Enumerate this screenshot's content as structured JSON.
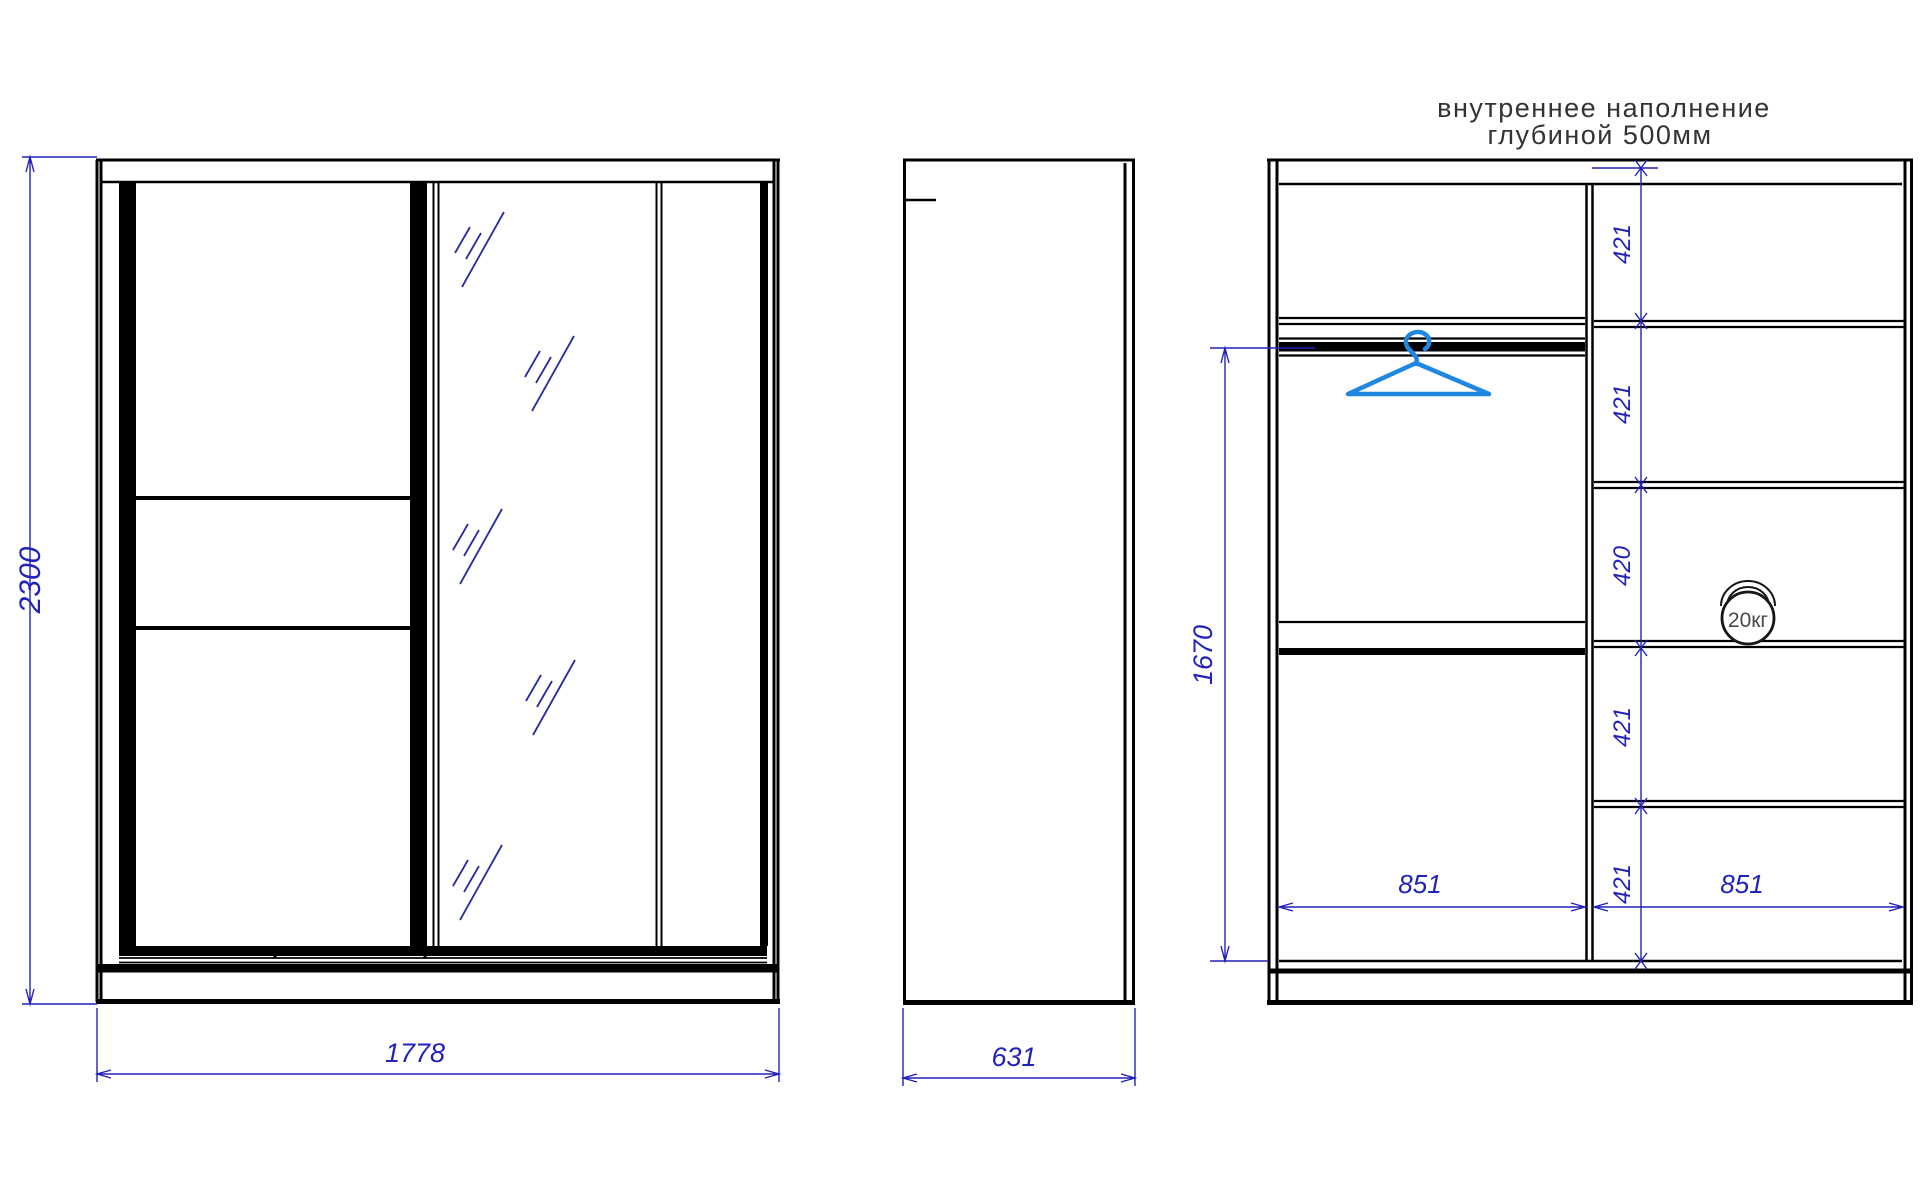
{
  "drawing": {
    "title": {
      "line1": "внутреннее наполнение",
      "line2": "глубиной 500мм"
    },
    "dimensions": {
      "height": "2300",
      "width": "1778",
      "depth": "631",
      "rod_height": "1670",
      "left_section_width": "851",
      "right_section_width": "851",
      "shelf_gaps": [
        "421",
        "421",
        "420",
        "421",
        "421"
      ]
    },
    "icons": {
      "weight_label": "20кг"
    },
    "colors": {
      "line": "#000000",
      "dimension": "#2222bb",
      "hanger": "#1f87e0",
      "hatch": "#2a2aa0"
    }
  }
}
